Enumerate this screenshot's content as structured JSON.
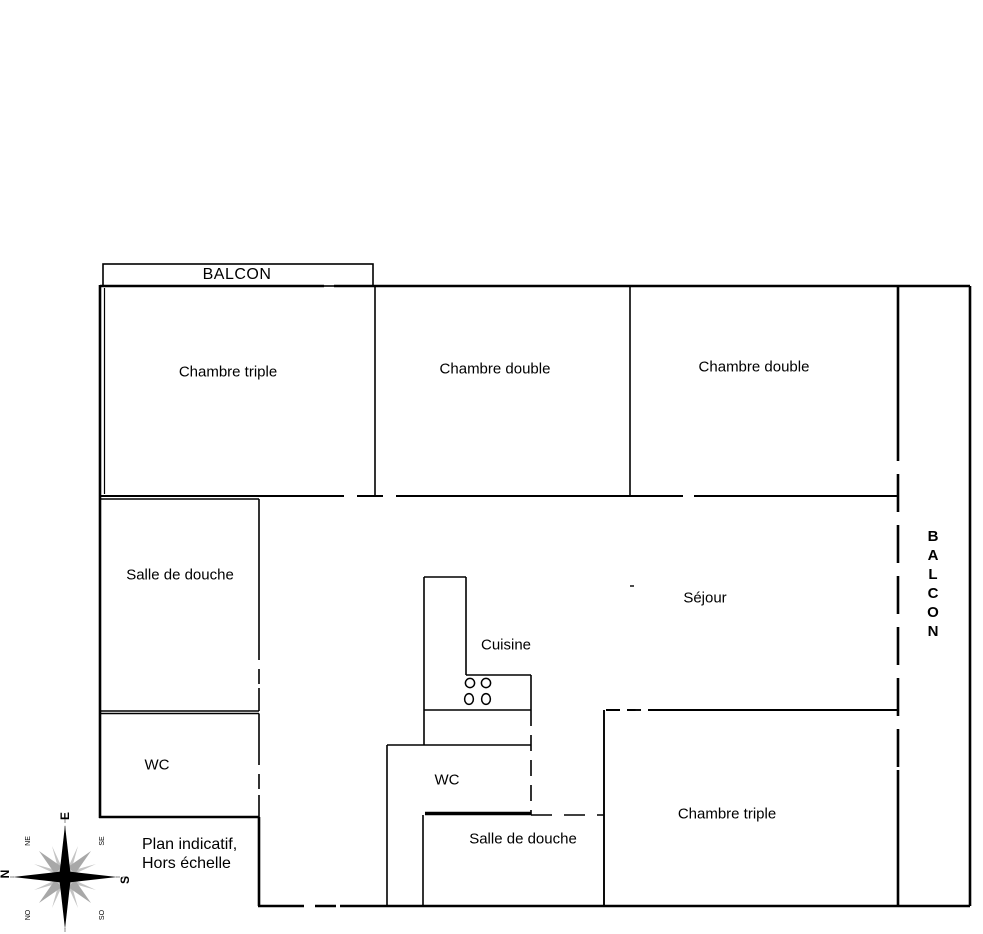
{
  "plan": {
    "note_line1": "Plan indicatif,",
    "note_line2": "Hors échelle"
  },
  "rooms": {
    "balcony_top": {
      "label": "BALCON"
    },
    "bedroom_triple_top": {
      "label": "Chambre triple"
    },
    "bedroom_double_mid": {
      "label": "Chambre double"
    },
    "bedroom_double_right": {
      "label": "Chambre double"
    },
    "shower_room_top": {
      "label": "Salle de douche"
    },
    "wc_top": {
      "label": "WC"
    },
    "kitchen": {
      "label": "Cuisine"
    },
    "living_room": {
      "label": "Séjour"
    },
    "balcony_right": {
      "label": "BALCON"
    },
    "wc_bottom": {
      "label": "WC"
    },
    "shower_room_bottom": {
      "label": "Salle de douche"
    },
    "bedroom_triple_bottom": {
      "label": "Chambre triple"
    }
  },
  "compass": {
    "east": "E",
    "south": "S",
    "west": "O",
    "north": "N",
    "northeast": "NE",
    "southeast": "SE",
    "southwest": "SO",
    "northwest": "NO"
  },
  "colors": {
    "wall": "#000000",
    "background": "#ffffff",
    "compass_gray": "#a8a8a8"
  }
}
